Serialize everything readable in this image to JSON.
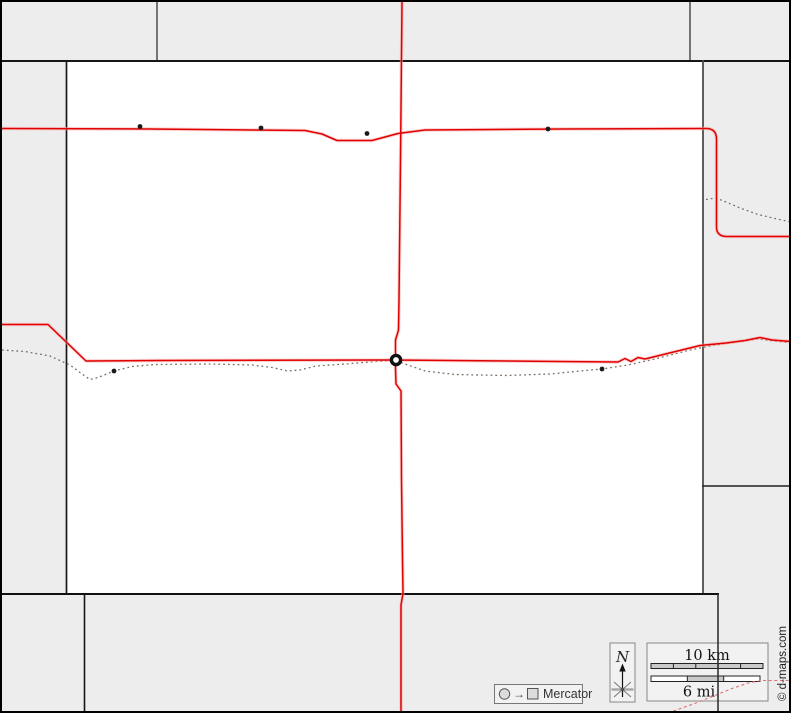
{
  "map": {
    "type": "county-outline-road-map",
    "copyright": "© d-maps.com",
    "legend": {
      "projection": {
        "label": "Mercator",
        "arrow": "→"
      },
      "north": {
        "label": "N"
      },
      "scale": {
        "km_label": "10 km",
        "mi_label": "6 mi"
      }
    },
    "icons": {
      "town-dot": "●",
      "county-seat-ring": "◎",
      "north-arrow": "↑",
      "compass-star": "✳",
      "projection-circle": "○",
      "projection-square": "□"
    },
    "colors": {
      "neighbor_fill": "#ededed",
      "county_fill": "#ffffff",
      "outer_frame": "#000000",
      "county_border": "#1a1a1a",
      "division_border": "#555555",
      "road_red": "#e00000",
      "road_halo": "#f7a8a8",
      "railroad_dashed": "#7a6e63",
      "minor_road_dashed": "#e07070",
      "legend_box_fill": "#f2f2f2",
      "legend_box_border": "#888888",
      "scale_bar_fill": "#c9c9c9",
      "text_dark": "#222222"
    }
  }
}
